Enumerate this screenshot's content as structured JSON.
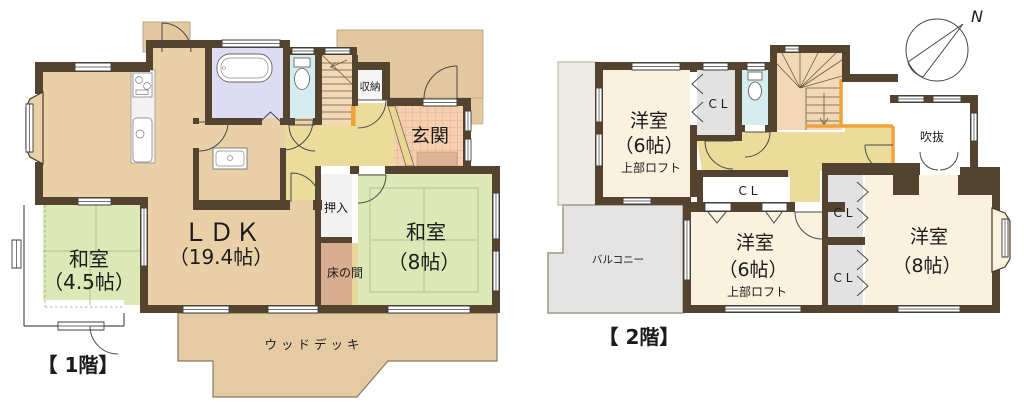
{
  "plan_colors": {
    "wall": "#54432f",
    "room_tan": "#e9d0a7",
    "tatami_green": "#dce8b6",
    "hall_yellow": "#ebdc9c",
    "genkan_tile": "#f5d0b0",
    "porch_tan": "#e3c79f",
    "deck_tan": "#e5cba3",
    "bath_lavender": "#dedcf2",
    "toilet_cyan": "#d6edef",
    "stairs_peach": "#f3d8b8",
    "closet_white": "#f5f5f5",
    "closet_gray": "#e2e2e2",
    "tokonoma_pink": "#d8ad90",
    "western_cream": "#faf1de",
    "balcony_gray": "#e4e4e4",
    "railing_orange": "#f0a238"
  },
  "f1": {
    "floor_label": "【 1階】",
    "ldk": {
      "name": "ＬＤＫ",
      "size": "（19.4帖）"
    },
    "washitsu45": {
      "name": "和室",
      "size": "（4.5帖）"
    },
    "washitsu8": {
      "name": "和室",
      "size": "（8帖）"
    },
    "genkan": "玄関",
    "shuno": "収納",
    "oshiire": "押入",
    "tokonoma": "床の間",
    "wood_deck": "ウッドデッキ"
  },
  "f2": {
    "floor_label": "【 2階】",
    "yoshitsu6_nw": {
      "name": "洋室",
      "size": "（6帖）",
      "loft": "上部ロフト"
    },
    "yoshitsu6_s": {
      "name": "洋室",
      "size": "（6帖）",
      "loft": "上部ロフト"
    },
    "yoshitsu8": {
      "name": "洋室",
      "size": "（8帖）"
    },
    "fukinuke": "吹抜",
    "balcony": "バルコニー",
    "closet": "C L",
    "north": "N"
  }
}
